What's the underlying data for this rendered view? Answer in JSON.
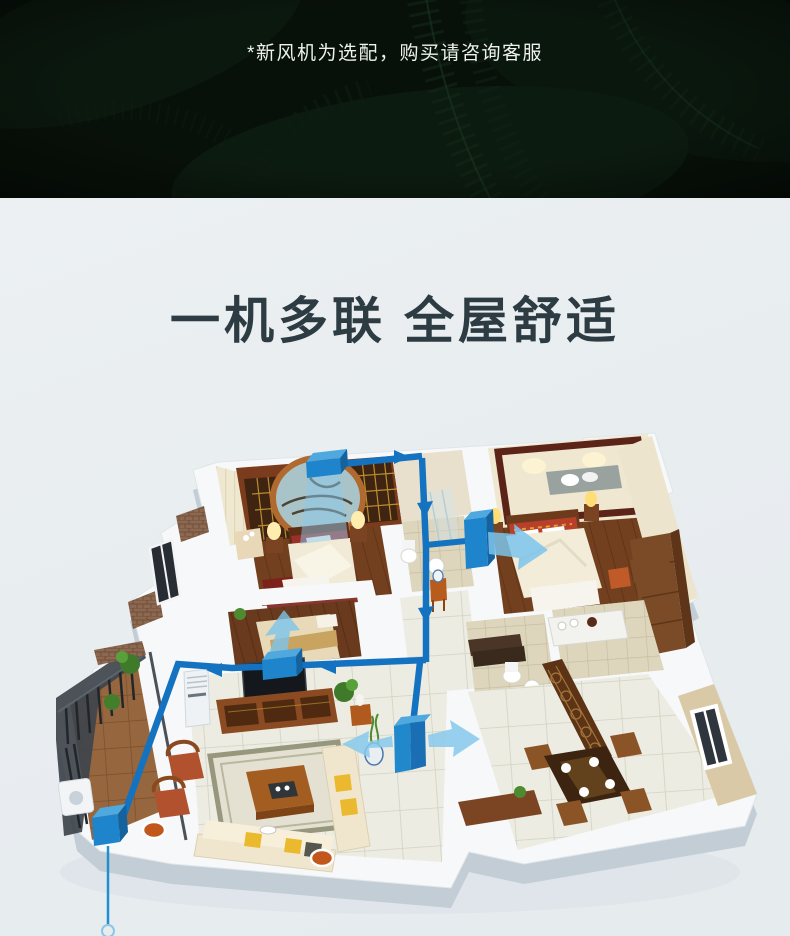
{
  "hero": {
    "note": "*新风机为选配，购买请咨询客服"
  },
  "section": {
    "headline": "一机多联 全屋舒适"
  },
  "colors": {
    "hero_background": "#081109",
    "body_background": "#e9edf0",
    "headline_text": "#2d3b43",
    "note_text": "#eef1ee",
    "duct_pipe": "#1473c0",
    "duct_vent_front": "#1e84cc",
    "duct_vent_top": "#4fa8de",
    "airflow_arrow": "#7cc4ec",
    "wood_floor": "#73401f",
    "tile_floor": "#edece2"
  }
}
